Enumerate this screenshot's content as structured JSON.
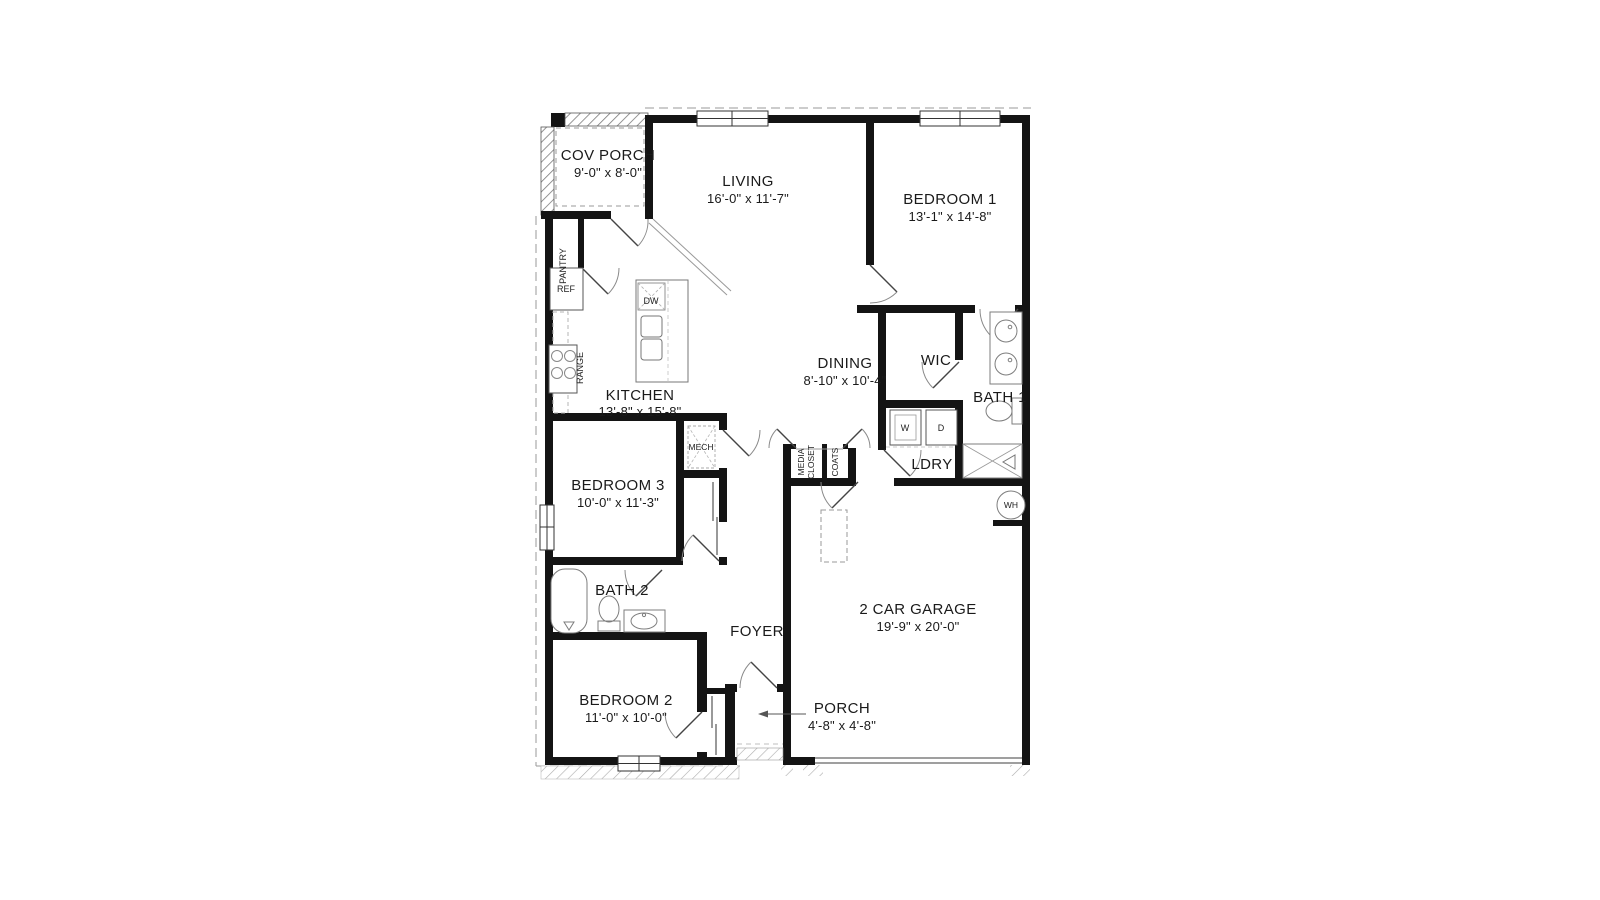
{
  "plan": {
    "rooms": {
      "cov_porch": {
        "name": "COV PORCH",
        "dims": "9'-0\" x 8'-0\""
      },
      "living": {
        "name": "LIVING",
        "dims": "16'-0\" x 11'-7\""
      },
      "bedroom1": {
        "name": "BEDROOM 1",
        "dims": "13'-1\" x 14'-8\""
      },
      "kitchen": {
        "name": "KITCHEN",
        "dims": "13'-8\" x 15'-8\""
      },
      "dining": {
        "name": "DINING",
        "dims": "8'-10\" x 10'-4\""
      },
      "wic": {
        "name": "WIC"
      },
      "bath1": {
        "name": "BATH 1"
      },
      "ldry": {
        "name": "LDRY"
      },
      "mech": {
        "name": "MECH"
      },
      "bedroom3": {
        "name": "BEDROOM 3",
        "dims": "10'-0\" x 11'-3\""
      },
      "media_closet": {
        "line1": "MEDIA",
        "line2": "CLOSET"
      },
      "coats": {
        "name": "COATS"
      },
      "pantry": {
        "name": "PANTRY"
      },
      "bath2": {
        "name": "BATH 2"
      },
      "foyer": {
        "name": "FOYER"
      },
      "bedroom2": {
        "name": "BEDROOM 2",
        "dims": "11'-0\" x 10'-0\""
      },
      "porch": {
        "name": "PORCH",
        "dims": "4'-8\" x 4'-8\""
      },
      "garage": {
        "name": "2 CAR GARAGE",
        "dims": "19'-9\" x 20'-0\""
      }
    },
    "fixtures": {
      "ref": "REF",
      "range": "RANGE",
      "dw": "DW",
      "washer": "W",
      "dryer": "D",
      "water_heater": "WH"
    },
    "colors": {
      "wall": "#141414",
      "thin_line": "#888888",
      "hatch": "#8f8f8f",
      "background": "#ffffff"
    }
  }
}
